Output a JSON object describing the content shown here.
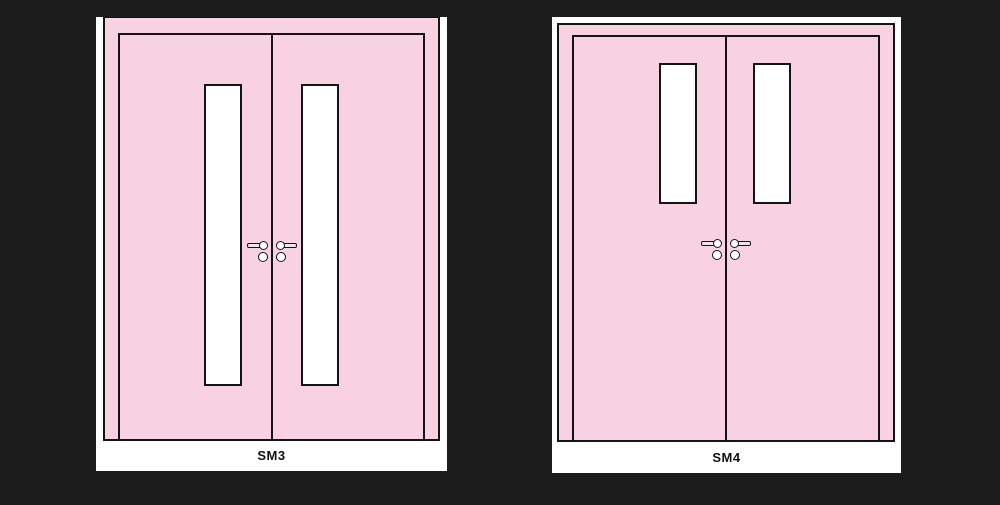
{
  "title": "Door type elevation drawings",
  "colors": {
    "canvas-bg": "#1b1b1b",
    "door-pink": "#f8d2e3",
    "frame-white": "#ffffff",
    "line-black": "#141414",
    "hardware-fill": "#e8e8e8",
    "label-color": "#111111"
  },
  "doors": [
    {
      "label": "SM3",
      "leaf_count": 2,
      "vision_panels": {
        "count": 2,
        "style": "tall-narrow-full-height"
      },
      "hardware": "paired lever handles with round escutcheons"
    },
    {
      "label": "SM4",
      "leaf_count": 2,
      "vision_panels": {
        "count": 2,
        "style": "short-upper"
      },
      "hardware": "paired lever handles with round escutcheons"
    }
  ]
}
